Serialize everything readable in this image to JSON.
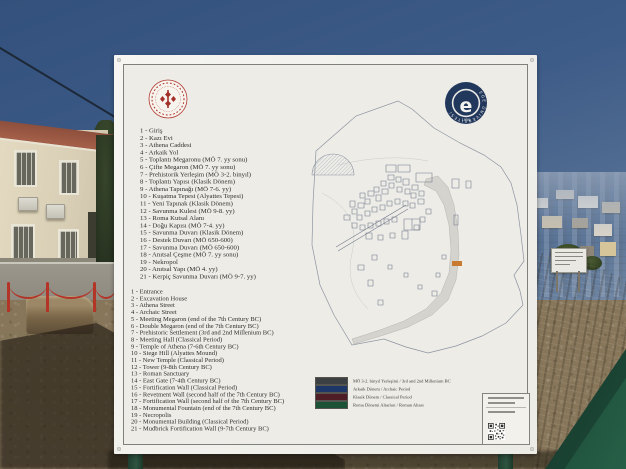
{
  "board": {
    "logos": {
      "university": {
        "ring_text": "EGE ÜNİVERSİTESİ",
        "year": "1955",
        "letter": "e"
      }
    },
    "list_tr": [
      "1 - Giriş",
      "2 - Kazı Evi",
      "3 - Athena Caddesi",
      "4 - Arkaik Yol",
      "5 - Toplantı Megaronu (MÖ 7. yy sonu)",
      "6 - Çifte Megaron (MÖ 7. yy sonu)",
      "7 - Prehistorik Yerleşim (MÖ 3-2. binyıl)",
      "8 - Toplantı Yapısı (Klasik Dönem)",
      "9 - Athena Tapınağı (MÖ 7-6. yy)",
      "10 - Kuşatma Tepesi (Alyattes Tepesi)",
      "11 - Yeni Tapınak (Klasik Dönem)",
      "12 - Savunma Kulesi (MÖ 9-8. yy)",
      "13 - Roma Kutsal Alanı",
      "14 - Doğu Kapısı (MÖ 7-4. yy)",
      "15 - Savunma Duvarı (Klasik Dönem)",
      "16 - Destek Duvarı (MÖ 650-600)",
      "17 - Savunma Duvarı (MÖ 650-600)",
      "18 - Anıtsal Çeşme (MÖ 7. yy sonu)",
      "19 - Nekropol",
      "20 - Anıtsal Yapı (MÖ 4. yy)",
      "21 - Kerpiç Savunma Duvarı (MÖ 9-7. yy)"
    ],
    "list_en": [
      "1 - Entrance",
      "2 - Excavation House",
      "3 - Athena Street",
      "4 - Archaic Street",
      "5 - Meeting Megaron (end of the 7th Century BC)",
      "6 - Double Megaron (end of the 7th Century BC)",
      "7 - Prehistoric Settlement (3rd and 2nd Millenium BC)",
      "8 - Meeting Hall (Classical Period)",
      "9 - Temple of Athena (7-6th Century BC)",
      "10 - Siege Hill (Alyattes Mound)",
      "11 - New Temple (Classical Period)",
      "12 - Tower (9-8th Century BC)",
      "13 - Roman Sanctuary",
      "14 - East Gate (7-4th Century BC)",
      "15 - Fortification Wall (Classical Period)",
      "16 - Revetment Wall (second half of the 7th Century BC)",
      "17 - Fortification Wall (second half of the 7th Century BC)",
      "18 - Monumental Fountain (end of the 7th Century BC)",
      "19 - Necropolis",
      "20 - Monumental Building (Classical Period)",
      "21 - Mudbrick Fortification Wall (9-7th Century BC)"
    ],
    "map_legend": [
      {
        "color": "#3c4043",
        "label": "MÖ 3-2. binyıl Yerleşimi / 3rd and 2nd Millenium BC"
      },
      {
        "color": "#1c3667",
        "label": "Arkaik Dönem / Archaic Period"
      },
      {
        "color": "#4f1d26",
        "label": "Klasik Dönem / Classical Period"
      },
      {
        "color": "#1c5236",
        "label": "Roma Dönemi Altarları / Roman Altars"
      }
    ],
    "map_marker_color": "#c87a30"
  }
}
